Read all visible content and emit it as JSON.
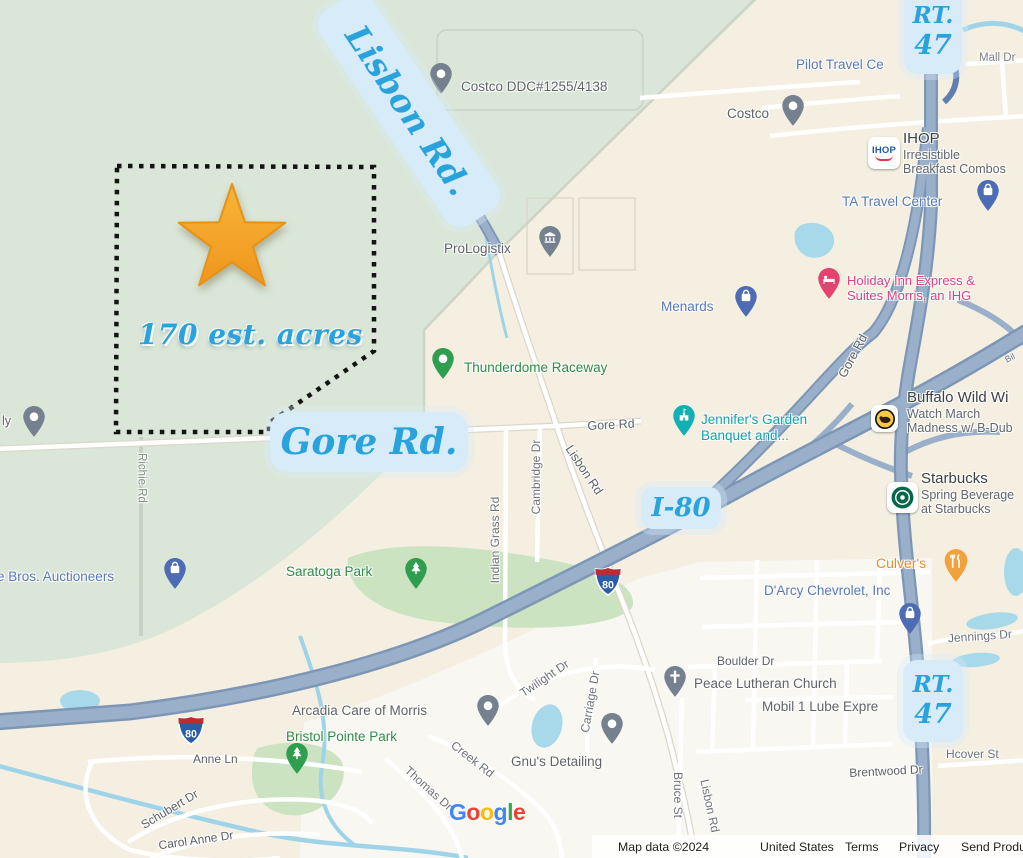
{
  "colors": {
    "annotation_blue": "#2aa3dd",
    "badge_bg": "#d7ecf8",
    "star_gold": "#f5a623",
    "map_green": "#dae6d8",
    "map_beige": "#f4efe1",
    "park_green": "#cbe3c1",
    "highway": "#9ab0ca",
    "water": "#a7d9eb",
    "parcel_border": "#141414",
    "poi_blue": "#5878ba",
    "poi_green": "#2e8b46",
    "poi_teal": "#0fa3ab",
    "poi_pink": "#e23d7f",
    "poi_orange": "#ee8a21"
  },
  "annotations": {
    "lisbon_rd": "Lisbon Rd.",
    "gore_rd": "Gore Rd.",
    "i80": "I-80",
    "rt47_line1": "RT.",
    "rt47_line2": "47",
    "acreage": "170 est. acres"
  },
  "shields": {
    "i80": "80"
  },
  "pois": {
    "pilot_travel": "Pilot Travel Ce",
    "costco": "Costco",
    "costco_ddc": "Costco DDC#1255/4138",
    "ihop": {
      "logo": "IHOP",
      "title": "IHOP",
      "line1": "Irresistible",
      "line2": "Breakfast Combos"
    },
    "ta_travel": "TA Travel Center",
    "holiday_inn": {
      "line1": "Holiday Inn Express &",
      "line2": "Suites Morris, an IHG"
    },
    "menards": "Menards",
    "prologistix": "ProLogistix",
    "thunderdome": "Thunderdome Raceway",
    "jennifers": {
      "line1": "Jennifer's Garden",
      "line2": "Banquet and..."
    },
    "buffalo": {
      "title": "Buffalo Wild Wi",
      "line1": "Watch March",
      "line2": "Madness w/ B-Dub"
    },
    "starbucks": {
      "title": "Starbucks",
      "line1": "Spring Beverage",
      "line2": "at Starbucks"
    },
    "culvers": "Culver's",
    "darcy": "D'Arcy Chevrolet, Inc",
    "ritchie_bros": "ie Bros. Auctioneers",
    "partial_ly": "ly",
    "saratoga_park": "Saratoga Park",
    "arcadia": "Arcadia Care of Morris",
    "bristol_pointe": "Bristol Pointe Park",
    "gnus": "Gnu's Detailing",
    "peace_lutheran": "Peace Lutheran Church",
    "mobil": "Mobil 1 Lube Expre"
  },
  "roads": {
    "gore_rd": "Gore Rd",
    "lisbon_rd": "Lisbon Rd",
    "richie_rd": "Richie Rd",
    "mall_dr": "Mall Dr",
    "indian_grass_rd": "Indian Grass Rd",
    "cambridge_dr": "Cambridge Dr",
    "jennings_dr": "Jennings Dr",
    "boulder_dr": "Boulder Dr",
    "brentwood_dr": "Brentwood Dr",
    "hcover_st": "Hcover St",
    "bruce_st": "Bruce St",
    "anne_ln": "Anne Ln",
    "schubert_dr": "Schubert Dr",
    "carol_anne_dr": "Carol Anne Dr",
    "twilight_dr": "Twilight Dr",
    "carriage_dr": "Carriage Dr",
    "creek_rd": "Creek Rd",
    "thomas_dr": "Thomas Dr",
    "bil_fragment": "Bil"
  },
  "attribution": {
    "map_data": "Map data ©2024",
    "country": "United States",
    "terms": "Terms",
    "privacy": "Privacy",
    "feedback": "Send Produ",
    "google_letters": [
      {
        "ch": "G",
        "color": "#4285F4"
      },
      {
        "ch": "o",
        "color": "#EA4335"
      },
      {
        "ch": "o",
        "color": "#FBBC05"
      },
      {
        "ch": "g",
        "color": "#4285F4"
      },
      {
        "ch": "l",
        "color": "#34A853"
      },
      {
        "ch": "e",
        "color": "#EA4335"
      }
    ]
  }
}
